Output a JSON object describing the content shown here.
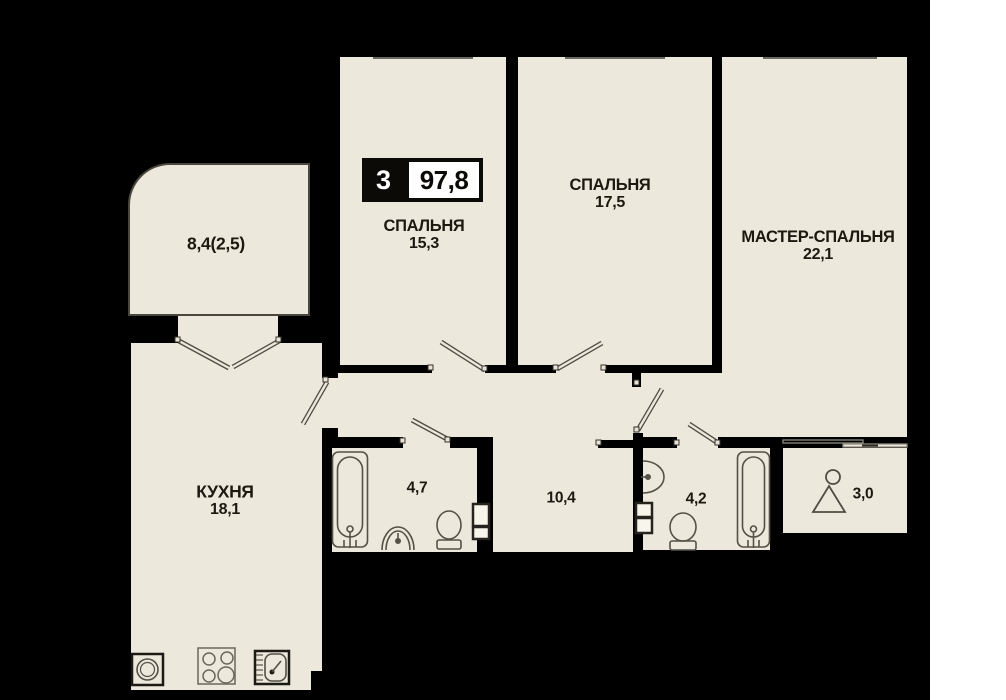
{
  "badge": {
    "rooms": "3",
    "total_area": "97,8"
  },
  "rooms": {
    "balcony": {
      "area": "8,4(2,5)"
    },
    "bedroom1": {
      "name": "СПАЛЬНЯ",
      "area": "15,3"
    },
    "bedroom2": {
      "name": "СПАЛЬНЯ",
      "area": "17,5"
    },
    "master": {
      "name": "МАСТЕР-СПАЛЬНЯ",
      "area": "22,1"
    },
    "kitchen": {
      "name": "КУХНЯ",
      "area": "18,1"
    },
    "bathroom1": {
      "area": "4,7"
    },
    "hallway": {
      "area": "10,4"
    },
    "bathroom2": {
      "area": "4,2"
    },
    "wardrobe": {
      "area": "3,0"
    }
  },
  "icons": [
    "bathtub-icon",
    "toilet-icon",
    "pedestal-sink-icon",
    "wall-sink-icon",
    "hanger-icon",
    "washing-machine-icon",
    "stove-icon",
    "kitchen-sink-icon",
    "door-swing-icon",
    "sliding-door-icon",
    "window-icon",
    "duct-shaft-icon"
  ],
  "colors": {
    "floor": "#ECE8DC",
    "wall": "#000000",
    "fixture_line": "#555147",
    "badge_bg": "#0b0a07",
    "badge_text": "#ffffff",
    "label_text": "#1b1910"
  }
}
